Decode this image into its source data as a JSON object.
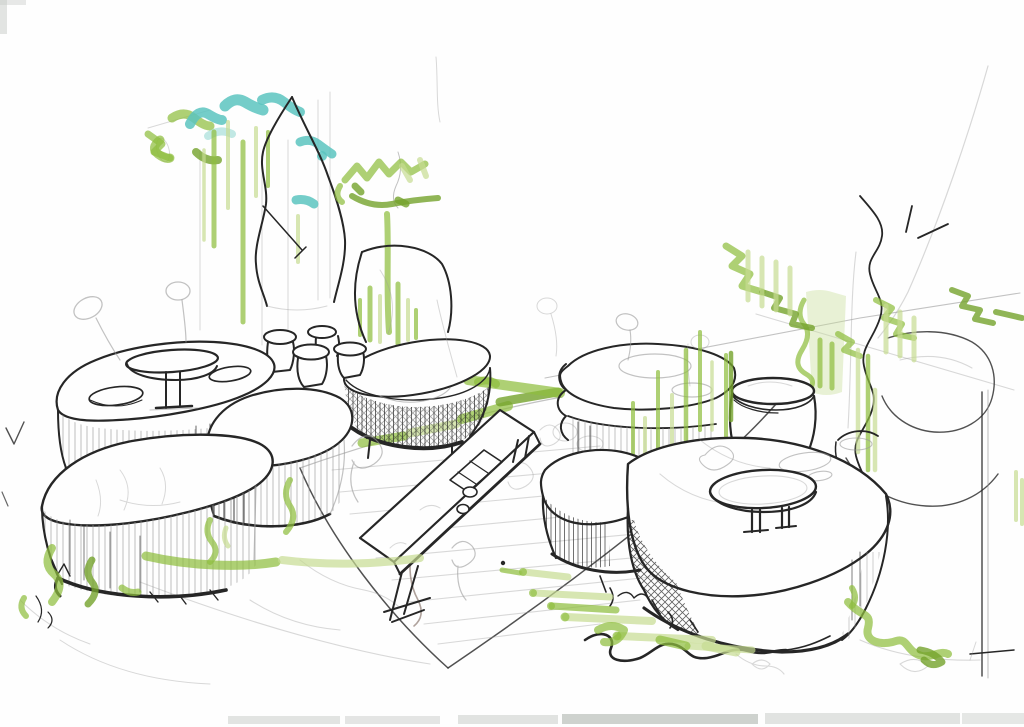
{
  "meta": {
    "title": "Garden seating landscape — concept sketch",
    "medium": "ink pen, pencil and green/teal marker on white paper",
    "description": "Hand-drawn perspective concept sketch of an outdoor seating landscape: two clusters of rounded stone boulders with pedestal tables, mushroom-shaped stools and an oval hatched counter flank a central paved walkway holding a long communal table; trees, grasses and climbing planting are highlighted with green and teal marker strokes."
  },
  "palette": {
    "paper": "#fefefe",
    "ink": "#262626",
    "ink_soft": "#3a3a3a",
    "pencil": "#9a9a9a",
    "pencil_warm": "#8d7b72",
    "marker": "#8fbe3e",
    "marker_light": "#c6dc92",
    "marker_dark": "#74a32c",
    "teal": "#5cc4c0",
    "teal_light": "#97d8d2",
    "scan_band": "#dfe1df",
    "scan_band_dark": "#c9cdc9"
  },
  "scene": {
    "groups": [
      {
        "name": "left-trees",
        "description": "tree canopy in teal and green marker with vertical trunk strokes"
      },
      {
        "name": "monolith-rock",
        "description": "tall pointed standing rock in pen"
      },
      {
        "name": "right-tree",
        "description": "small tree with zigzag marker canopy and green stem"
      },
      {
        "name": "tree-rock",
        "description": "rounded rock beside the small tree"
      },
      {
        "name": "right-backdrop",
        "description": "pencil construction lines, pen branch line, marker vine zigzags and thin pole"
      },
      {
        "name": "walkway",
        "description": "central paved path with pencil hatching converging to the foreground"
      },
      {
        "name": "oval-counter",
        "description": "oval stone counter with dense cross-hatched side"
      },
      {
        "name": "stone-stools",
        "description": "mushroom shaped stone stools"
      },
      {
        "name": "left-platform",
        "description": "boulder platform carrying a round pedestal table and seat hollows"
      },
      {
        "name": "left-front-boulders",
        "description": "flat front boulder and faceted mid boulder with hatched sides and grass"
      },
      {
        "name": "long-table",
        "description": "long communal table with board, cups and sketched figures"
      },
      {
        "name": "right-cluster",
        "description": "boulder group with kettle stool and large rock carrying a round pedestal table"
      },
      {
        "name": "planting",
        "description": "green marker grasses, strips and vines around the bases"
      },
      {
        "name": "scan-artifacts",
        "description": "light scanner band at the bottom edge and corner mark"
      }
    ]
  }
}
